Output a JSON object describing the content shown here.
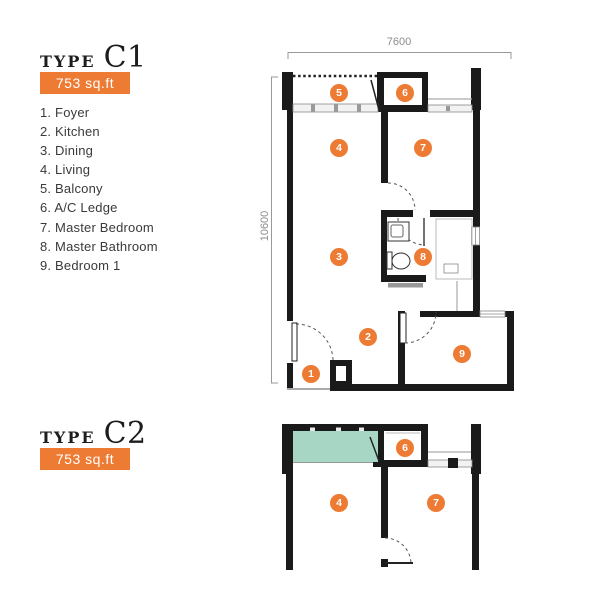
{
  "page": {
    "background": "#ffffff"
  },
  "colors": {
    "accent_orange": "#EE7B33",
    "wall_black": "#1A1A1A",
    "dimension_gray": "#8C8C8C",
    "heading_text": "#1D1D1B",
    "legend_text": "#3A3A39",
    "balcony_fill_green": "#A7D7C4",
    "window_gray": "#F2F2F2"
  },
  "plan_c1": {
    "type_label": "TYPE",
    "type_code": "C1",
    "area_badge": "753 sq.ft",
    "legend": [
      "1. Foyer",
      "2. Kitchen",
      "3. Dining",
      "4. Living",
      "5. Balcony",
      "6. A/C Ledge",
      "7. Master Bedroom",
      "8. Master Bathroom",
      "9. Bedroom 1"
    ],
    "dim_top": "7600",
    "dim_left": "10600",
    "markers": [
      {
        "num": "5"
      },
      {
        "num": "6"
      },
      {
        "num": "4"
      },
      {
        "num": "7"
      },
      {
        "num": "3"
      },
      {
        "num": "8"
      },
      {
        "num": "2"
      },
      {
        "num": "1"
      },
      {
        "num": "9"
      }
    ]
  },
  "plan_c2": {
    "type_label": "TYPE",
    "type_code": "C2",
    "area_badge": "753 sq.ft",
    "markers": [
      {
        "num": "6"
      },
      {
        "num": "4"
      },
      {
        "num": "7"
      }
    ]
  }
}
